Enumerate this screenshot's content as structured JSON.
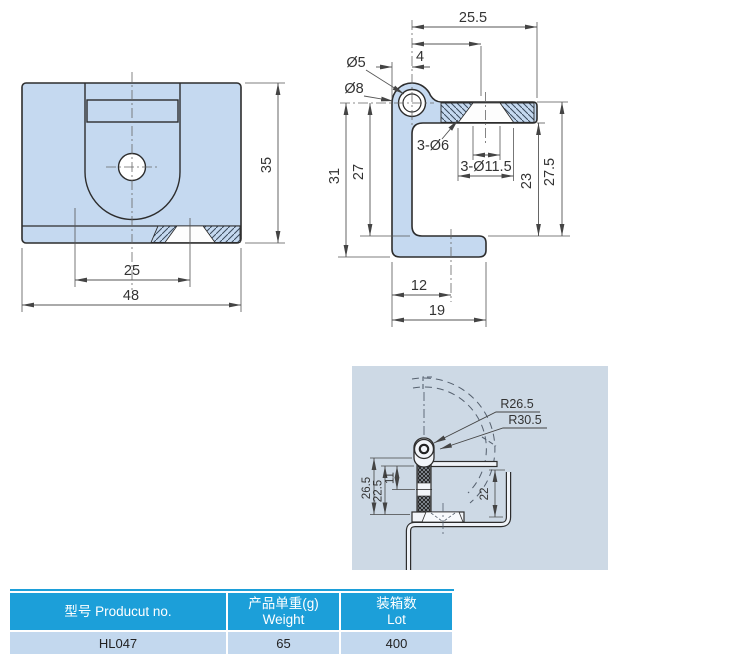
{
  "front_view": {
    "dim_hole_spacing": "25",
    "dim_width": "48",
    "dim_height": "35"
  },
  "side_view": {
    "dim_arm_length": "25.5",
    "dim_leg_thickness": "4",
    "dia_pin_hole": "Ø5",
    "dia_knuckle": "Ø8",
    "dia_holes_small": "3-Ø6",
    "dia_holes_csk": "3-Ø11.5",
    "dim_arm_to_flange": "23",
    "dim_arm_top_to_flange": "27.5",
    "dim_inner_height": "27",
    "dim_total_height": "31",
    "dim_hole_offset": "12",
    "dim_flange_length": "19"
  },
  "install_view": {
    "radius_inner": "R26.5",
    "radius_outer": "R30.5",
    "dim_26_5": "26.5",
    "dim_22_5": "22.5",
    "dim_11": "11",
    "dim_22": "22"
  },
  "table": {
    "headers": [
      {
        "cn": "型号",
        "en": "Producut no."
      },
      {
        "cn": "产品单重(g)",
        "en": "Weight"
      },
      {
        "cn": "装箱数",
        "en": "Lot"
      }
    ],
    "row": {
      "product_no": "HL047",
      "weight": "65",
      "lot": "400"
    }
  },
  "colors": {
    "part_fill": "#C5D9F0",
    "outline": "#2d2d2d",
    "dim_line": "#555555",
    "panel_bg": "#CDD9E5",
    "table_header": "#1C9FD9",
    "table_row": "#C3D8EE"
  }
}
